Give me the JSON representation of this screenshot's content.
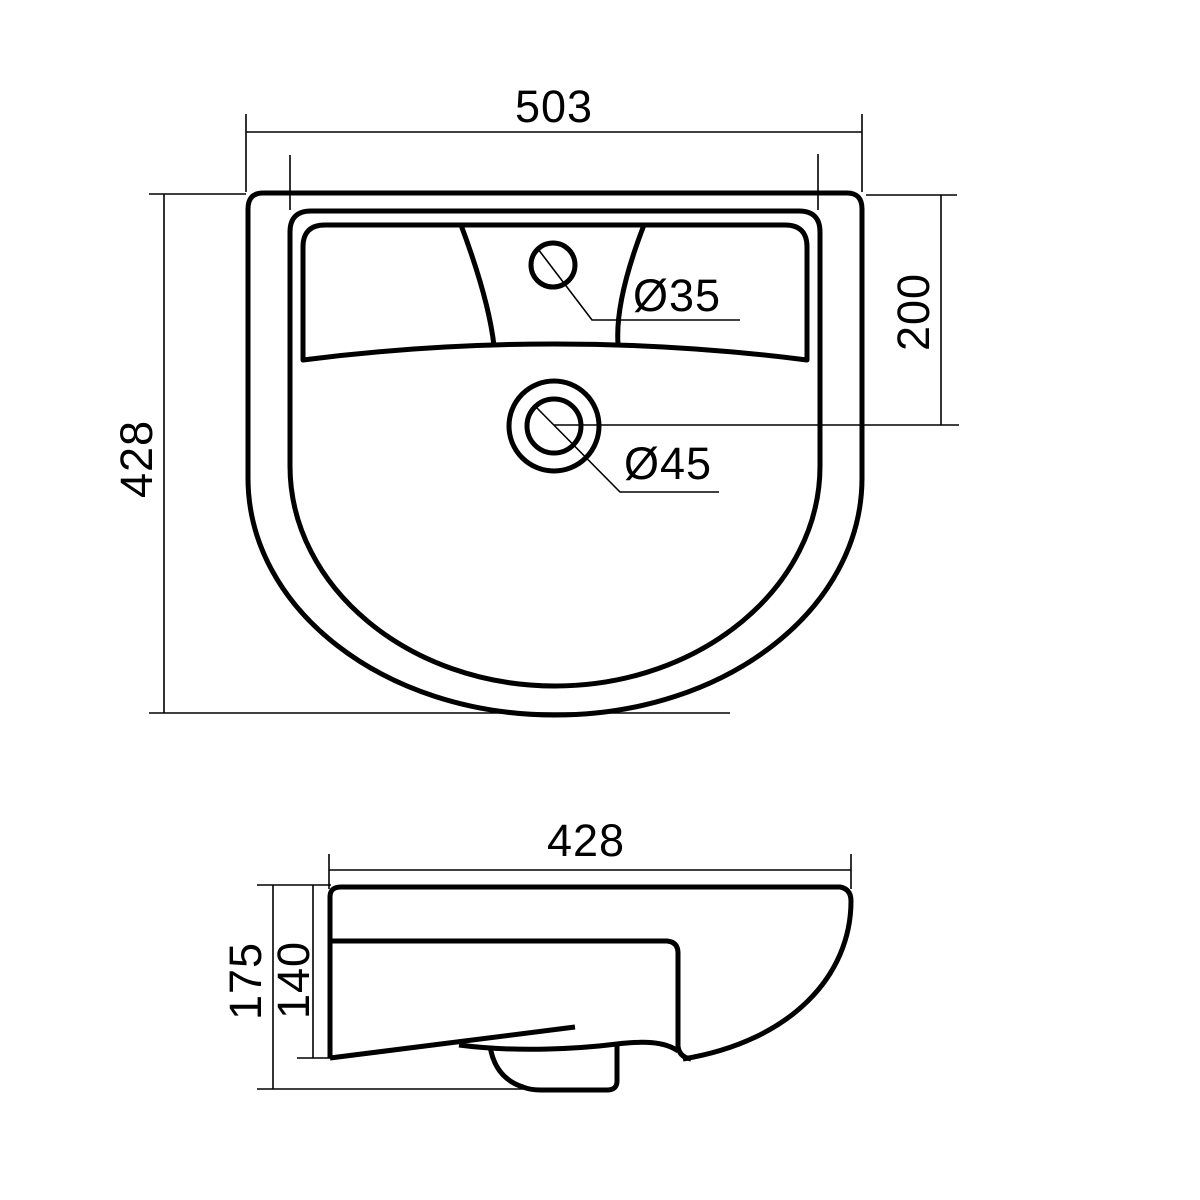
{
  "drawing": {
    "title": "washbasin dimensional drawing",
    "background_color": "#ffffff",
    "line_color": "#000000",
    "top_view": {
      "overall_width_mm": "503",
      "overall_depth_mm": "428",
      "drain_offset_mm": "200",
      "faucet_hole_diameter": "Ø35",
      "drain_hole_diameter": "Ø45"
    },
    "side_view": {
      "basin_width_mm": "428",
      "overall_height_mm": "175",
      "body_height_mm": "140"
    }
  }
}
